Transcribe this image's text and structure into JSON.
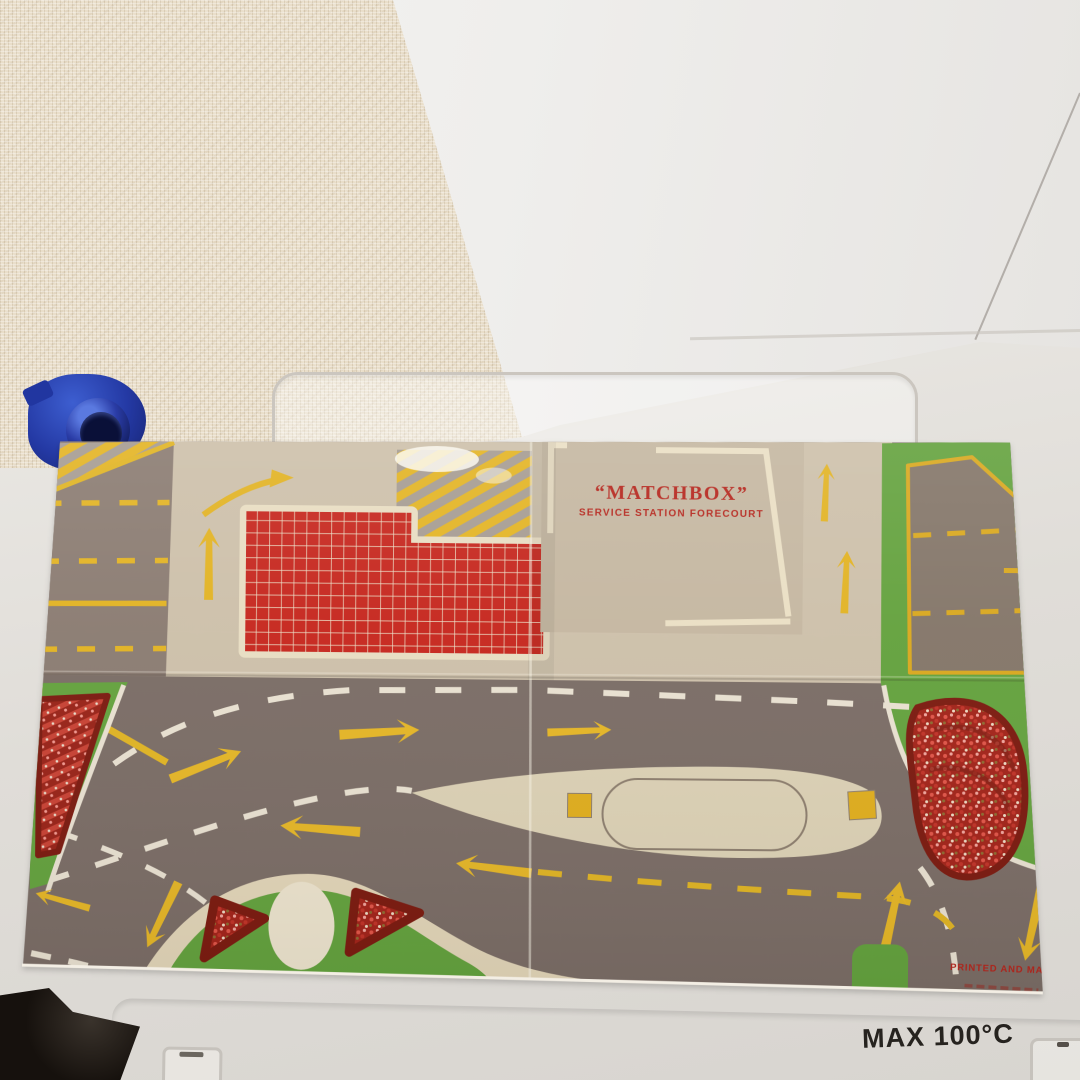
{
  "scene_items": [
    "textured-wallpaper",
    "white-board-lid",
    "white-table-tray",
    "blue-plastic-object",
    "dark-object",
    "matchbox-playmat"
  ],
  "mat": {
    "logo": {
      "line1": "“MATCHBOX”",
      "line2": "SERVICE STATION FORECOURT"
    },
    "printed_note": "PRINTED AND MADE IN",
    "colors": {
      "road_grey": "#7b6d66",
      "forecourt_tan": "#cdc0aa",
      "tile_red": "#c6271e",
      "marking_yellow": "#e3b424",
      "grass_green": "#64a23e",
      "kerb_cream": "#e2d5b8",
      "logo_red": "#b5261d"
    }
  },
  "surface": {
    "max_temp_label": "MAX 100°C",
    "toy_blue": "#2743ae"
  }
}
